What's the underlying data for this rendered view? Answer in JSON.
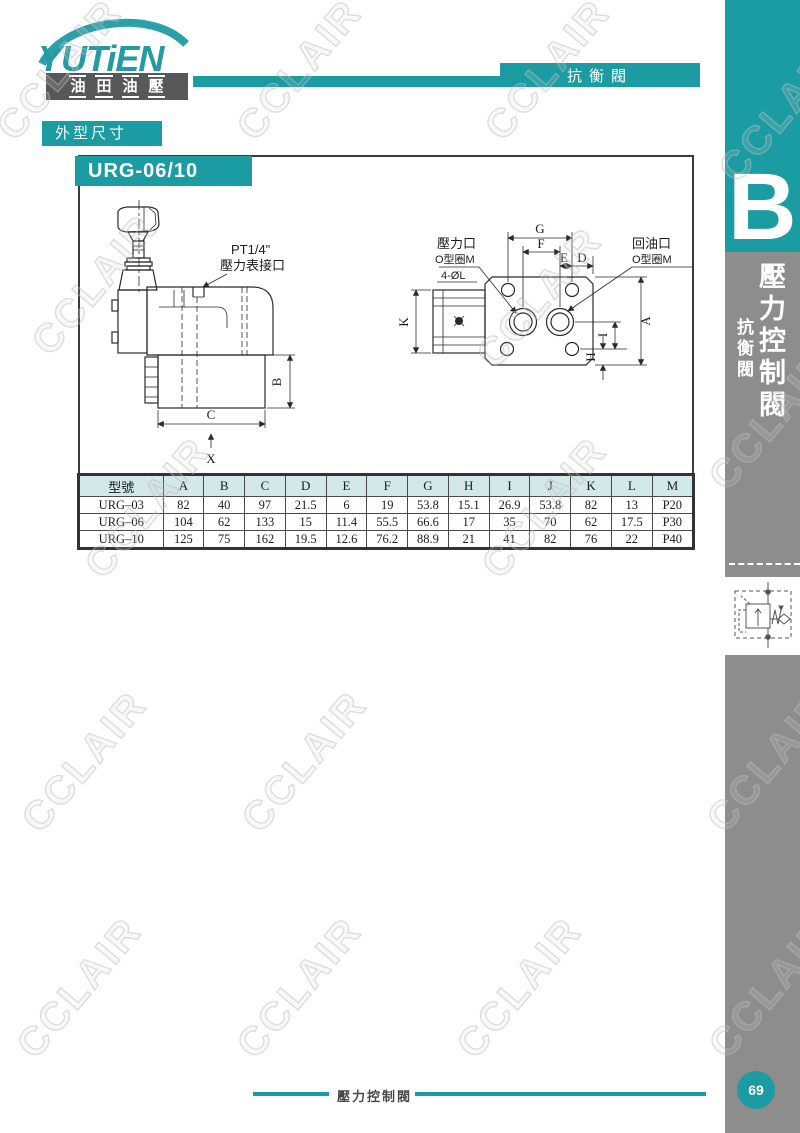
{
  "page": {
    "watermark": "CCLAIR",
    "colors": {
      "teal": "#1b9ba2",
      "sidebar_gray": "#8d8d8b",
      "table_header_bg": "#d3e8eb",
      "logo_box_dark": "#58585a"
    }
  },
  "brand": {
    "logo_text": "YUTiEN",
    "logo_subtitle": "油田油壓"
  },
  "header": {
    "category_tab": "抗衡閥",
    "section_label": "外型尺寸"
  },
  "sidebar": {
    "tab_letter": "B",
    "tab_title": "壓力控制閥",
    "tab_subtitle": "抗衡閥"
  },
  "content": {
    "model_header": "URG-06/10",
    "drawing_left": {
      "port_label_line1": "PT1/4\"",
      "port_label_line2": "壓力表接口",
      "dim_b": "B",
      "dim_c": "C",
      "dim_x": "X"
    },
    "drawing_right": {
      "pressure_port": "壓力口",
      "oring_left": "O型圈M",
      "bolt_holes": "4-ØL",
      "return_port": "回油口",
      "oring_right": "O型圈M",
      "dim_g": "G",
      "dim_f": "F",
      "dim_e": "E",
      "dim_d": "D",
      "dim_k": "K",
      "dim_a": "A",
      "dim_i": "I",
      "dim_h": "H"
    },
    "table": {
      "headers": [
        "型號",
        "A",
        "B",
        "C",
        "D",
        "E",
        "F",
        "G",
        "H",
        "I",
        "J",
        "K",
        "L",
        "M"
      ],
      "rows": [
        [
          "URG–03",
          "82",
          "40",
          "97",
          "21.5",
          "6",
          "19",
          "53.8",
          "15.1",
          "26.9",
          "53.8",
          "82",
          "13",
          "P20"
        ],
        [
          "URG–06",
          "104",
          "62",
          "133",
          "15",
          "11.4",
          "55.5",
          "66.6",
          "17",
          "35",
          "70",
          "62",
          "17.5",
          "P30"
        ],
        [
          "URG–10",
          "125",
          "75",
          "162",
          "19.5",
          "12.6",
          "76.2",
          "88.9",
          "21",
          "41",
          "82",
          "76",
          "22",
          "P40"
        ]
      ]
    }
  },
  "footer": {
    "label": "壓力控制閥",
    "page_number": "69"
  }
}
